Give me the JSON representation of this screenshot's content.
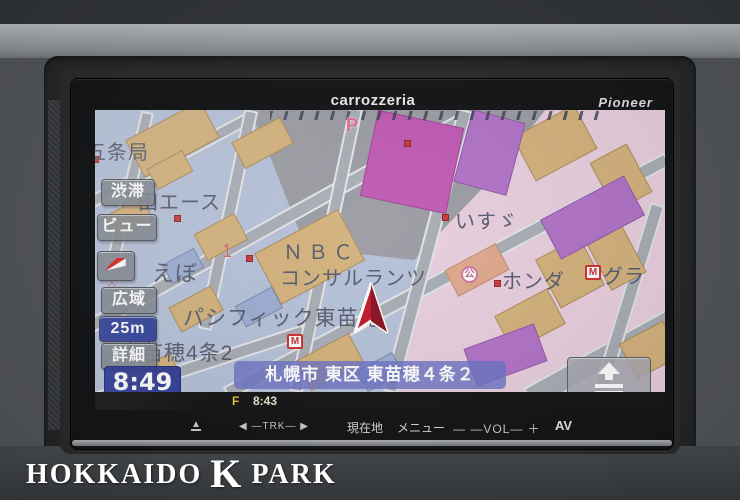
{
  "device": {
    "brand_center": "carrozzeria",
    "brand_right": "Pioneer",
    "hard_buttons": {
      "eject": "▲",
      "trk": "◀ —TRK— ▶",
      "current_location": "現在地",
      "menu": "メニュー",
      "volume": "— —VOL— ＋",
      "av": "AV"
    }
  },
  "screen": {
    "left_buttons": {
      "traffic": "渋滞",
      "view": "ビュー",
      "wide_area": "広域",
      "scale": "25m",
      "detail": "詳細"
    },
    "clock": "8:49",
    "address_bar": "札幌市 東区 東苗穂４条２",
    "av_source_indicator": "F",
    "av_time": "8:43",
    "map_labels": {
      "post_office": "五条局",
      "ace": "田エース",
      "ebo": "えぼ",
      "block_number": "1",
      "nbc_line1": "ＮＢＣ",
      "nbc_line2": "コンサルランツ",
      "pacific_higashinaebo": "パシフィック東苗穂",
      "higashinaebo_4jo2": "東苗穂4条2",
      "isuzu": "いすゞ",
      "honda": "ホンダ",
      "gura": "グラ",
      "parking_p": "P",
      "park_symbol": "公",
      "mansion_m": "M"
    }
  },
  "watermark": {
    "part1": "HOKKAIDO",
    "part2": "K",
    "part3": "PARK"
  },
  "colors": {
    "map_base": "#b6c2da",
    "map_zone_pink": "#e9cfdf",
    "map_zone_gray": "#9c9ca4",
    "building_tan": "#d4b27c",
    "building_purple": "#b273c8",
    "building_magenta": "#c05ab4",
    "road_gray": "#a9adb5",
    "scale_button_blue": "#32429e",
    "clock_blue": "#2b3a9a",
    "cursor_red": "#c01828",
    "accent_yellow": "#e6c23c"
  }
}
